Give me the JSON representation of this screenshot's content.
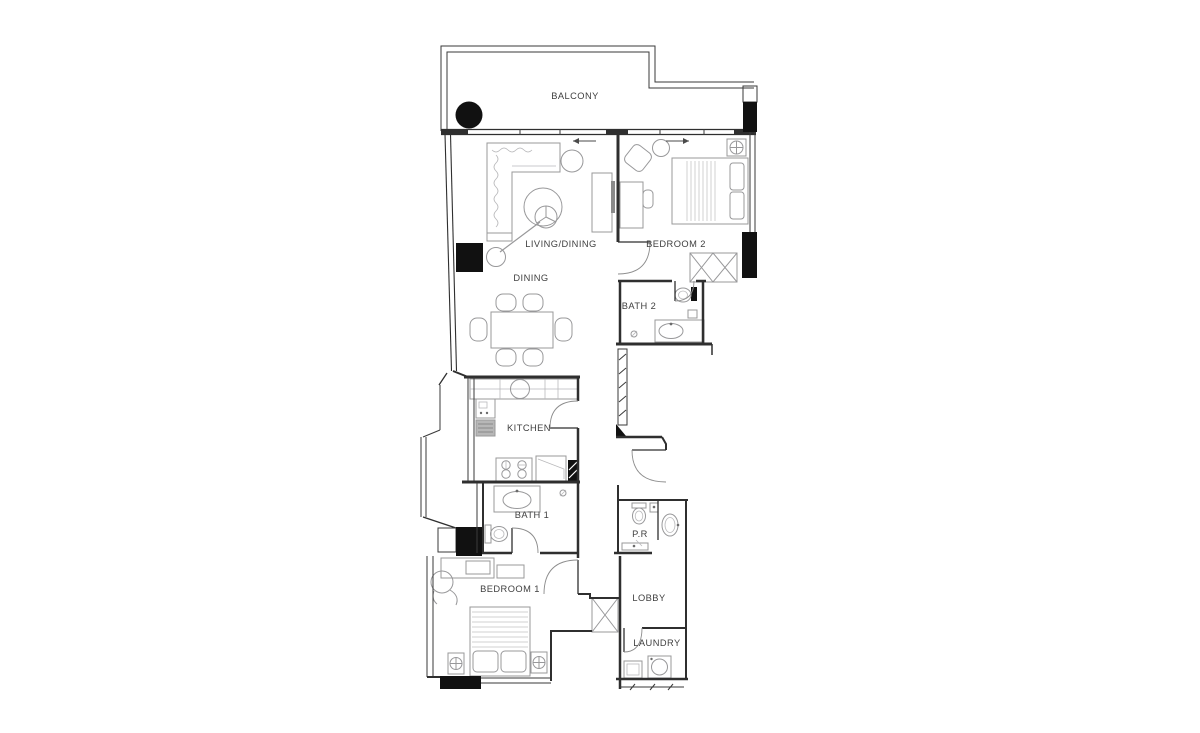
{
  "floorplan": {
    "type": "apartment-floor-plan",
    "rooms": [
      {
        "id": "balcony",
        "label": "BALCONY"
      },
      {
        "id": "living-dining",
        "label": "LIVING/DINING"
      },
      {
        "id": "dining",
        "label": "DINING"
      },
      {
        "id": "bedroom-2",
        "label": "BEDROOM 2"
      },
      {
        "id": "bath-2",
        "label": "BATH 2"
      },
      {
        "id": "kitchen",
        "label": "KITCHEN"
      },
      {
        "id": "bath-1",
        "label": "BATH 1"
      },
      {
        "id": "bedroom-1",
        "label": "BEDROOM 1"
      },
      {
        "id": "powder-room",
        "label": "P.R"
      },
      {
        "id": "lobby",
        "label": "LOBBY"
      },
      {
        "id": "laundry",
        "label": "LAUNDRY"
      }
    ],
    "colors": {
      "background": "#ffffff",
      "wall_ink": "#2f2f2f",
      "furniture_ink": "#98989a",
      "solid_fill": "#111111",
      "label_ink": "#3f3f3f"
    }
  }
}
